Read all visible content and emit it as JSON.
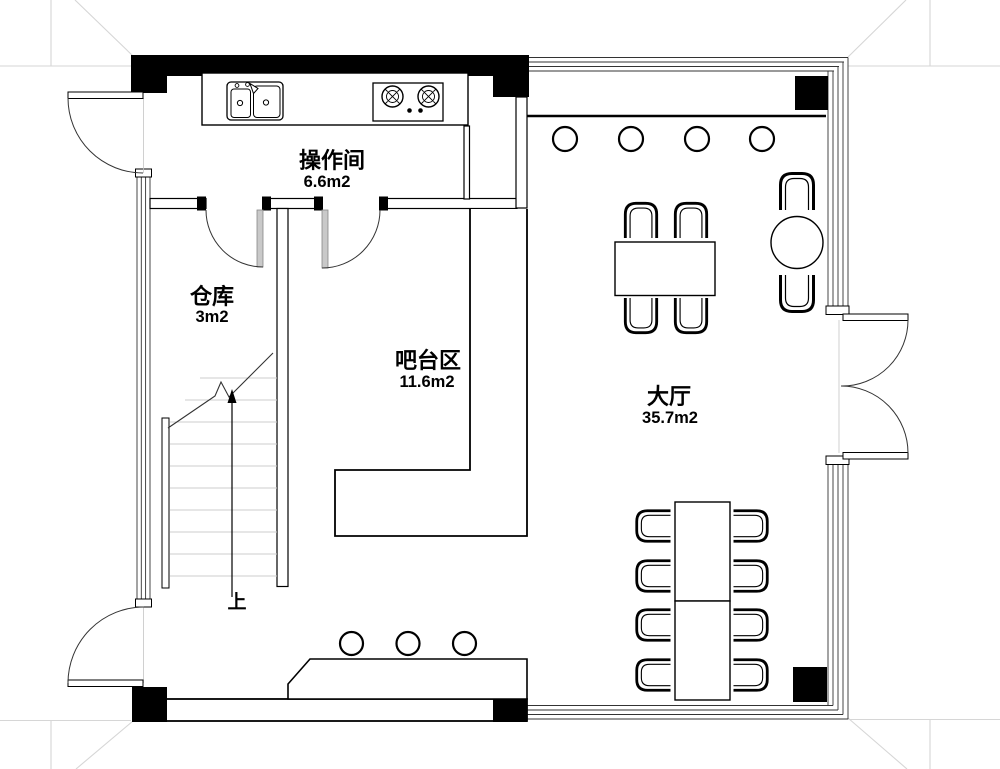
{
  "plan_labels": {
    "rooms": {
      "kitchen": {
        "name": "操作间",
        "area": "6.6m2"
      },
      "storage": {
        "name": "仓库",
        "area": "3m2"
      },
      "bar": {
        "name": "吧台区",
        "area": "11.6m2"
      },
      "hall": {
        "name": "大厅",
        "area": "35.7m2"
      }
    },
    "stairs": {
      "direction_label": "上"
    }
  },
  "furniture": {
    "hall_top_bar_stools": 4,
    "bottom_bar_stools": 3,
    "four_seat_table_chairs": 4,
    "round_table_chairs": 2,
    "long_table_chairs": 8
  },
  "colors": {
    "wall": "#000000",
    "line": "#333333",
    "grid_line": "#d6d6d6",
    "stair_tread": "#cccccc",
    "door_leaf": "#c9c9c9",
    "background": "#ffffff"
  }
}
